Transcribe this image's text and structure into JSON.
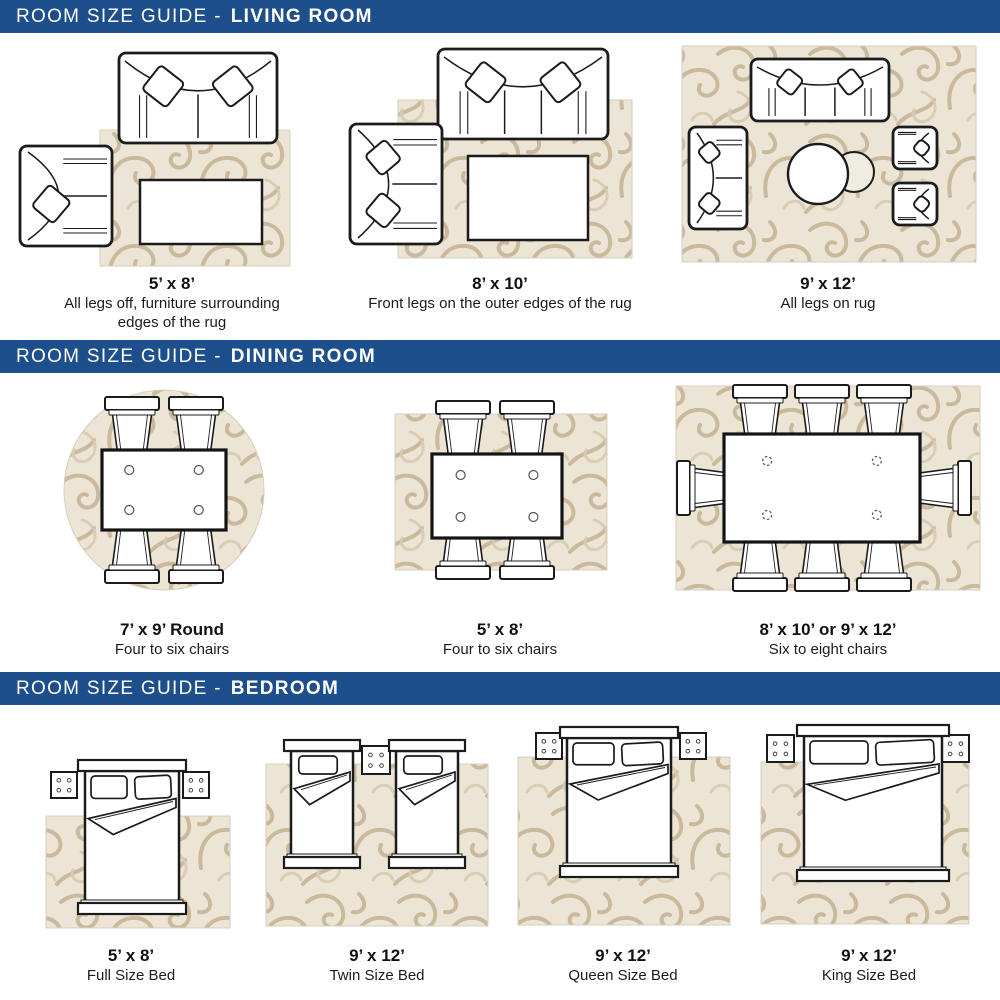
{
  "page_title": "Room Size Guide",
  "colors": {
    "header_bg": "#1e4f8d",
    "header_text": "#ffffff",
    "rug_base": "#ece4d4",
    "rug_swirl": "#c2ae90",
    "rug_swirl_light": "#d8cbb3",
    "line_ink": "#1b1b1b"
  },
  "sections": [
    {
      "id": "living-room",
      "title_prefix": "ROOM SIZE GUIDE -",
      "title_bold": "LIVING ROOM",
      "figures": [
        {
          "scene": "living-5x8",
          "illustration": "sofa-armchair-coffee-table-on-rug",
          "size": "5’ x 8’",
          "desc": "All legs off, furniture surrounding edges of the rug"
        },
        {
          "scene": "living-8x10",
          "illustration": "sofa-loveseat-coffee-table-on-rug",
          "size": "8’ x 10’",
          "desc": "Front legs on the outer edges of the rug"
        },
        {
          "scene": "living-9x12",
          "illustration": "sofa-loveseat-armchairs-round-tables-on-rug",
          "size": "9’ x 12’",
          "desc": "All legs on rug"
        }
      ]
    },
    {
      "id": "dining-room",
      "title_prefix": "ROOM SIZE GUIDE -",
      "title_bold": "DINING ROOM",
      "figures": [
        {
          "scene": "dining-7x9-round",
          "illustration": "dining-table-four-chairs-round-rug",
          "size": "7’ x 9’ Round",
          "desc": "Four to six chairs"
        },
        {
          "scene": "dining-5x8",
          "illustration": "dining-table-four-chairs-rug",
          "size": "5’ x 8’",
          "desc": "Four to six chairs"
        },
        {
          "scene": "dining-8x10-9x12",
          "illustration": "dining-table-eight-chairs-rug",
          "size": "8’ x 10’ or 9’ x 12’",
          "desc": "Six to eight chairs"
        }
      ]
    },
    {
      "id": "bedroom",
      "title_prefix": "ROOM SIZE GUIDE -",
      "title_bold": "BEDROOM",
      "figures": [
        {
          "scene": "bedroom-full",
          "illustration": "full-bed-nightstands-rug",
          "size": "5’ x 8’",
          "desc": "Full Size Bed"
        },
        {
          "scene": "bedroom-twin",
          "illustration": "two-twin-beds-nightstand-rug",
          "size": "9’ x 12’",
          "desc": "Twin Size Bed"
        },
        {
          "scene": "bedroom-queen",
          "illustration": "queen-bed-nightstands-rug",
          "size": "9’ x 12’",
          "desc": "Queen Size Bed"
        },
        {
          "scene": "bedroom-king",
          "illustration": "king-bed-nightstands-rug",
          "size": "9’ x 12’",
          "desc": "King Size Bed"
        }
      ]
    }
  ]
}
